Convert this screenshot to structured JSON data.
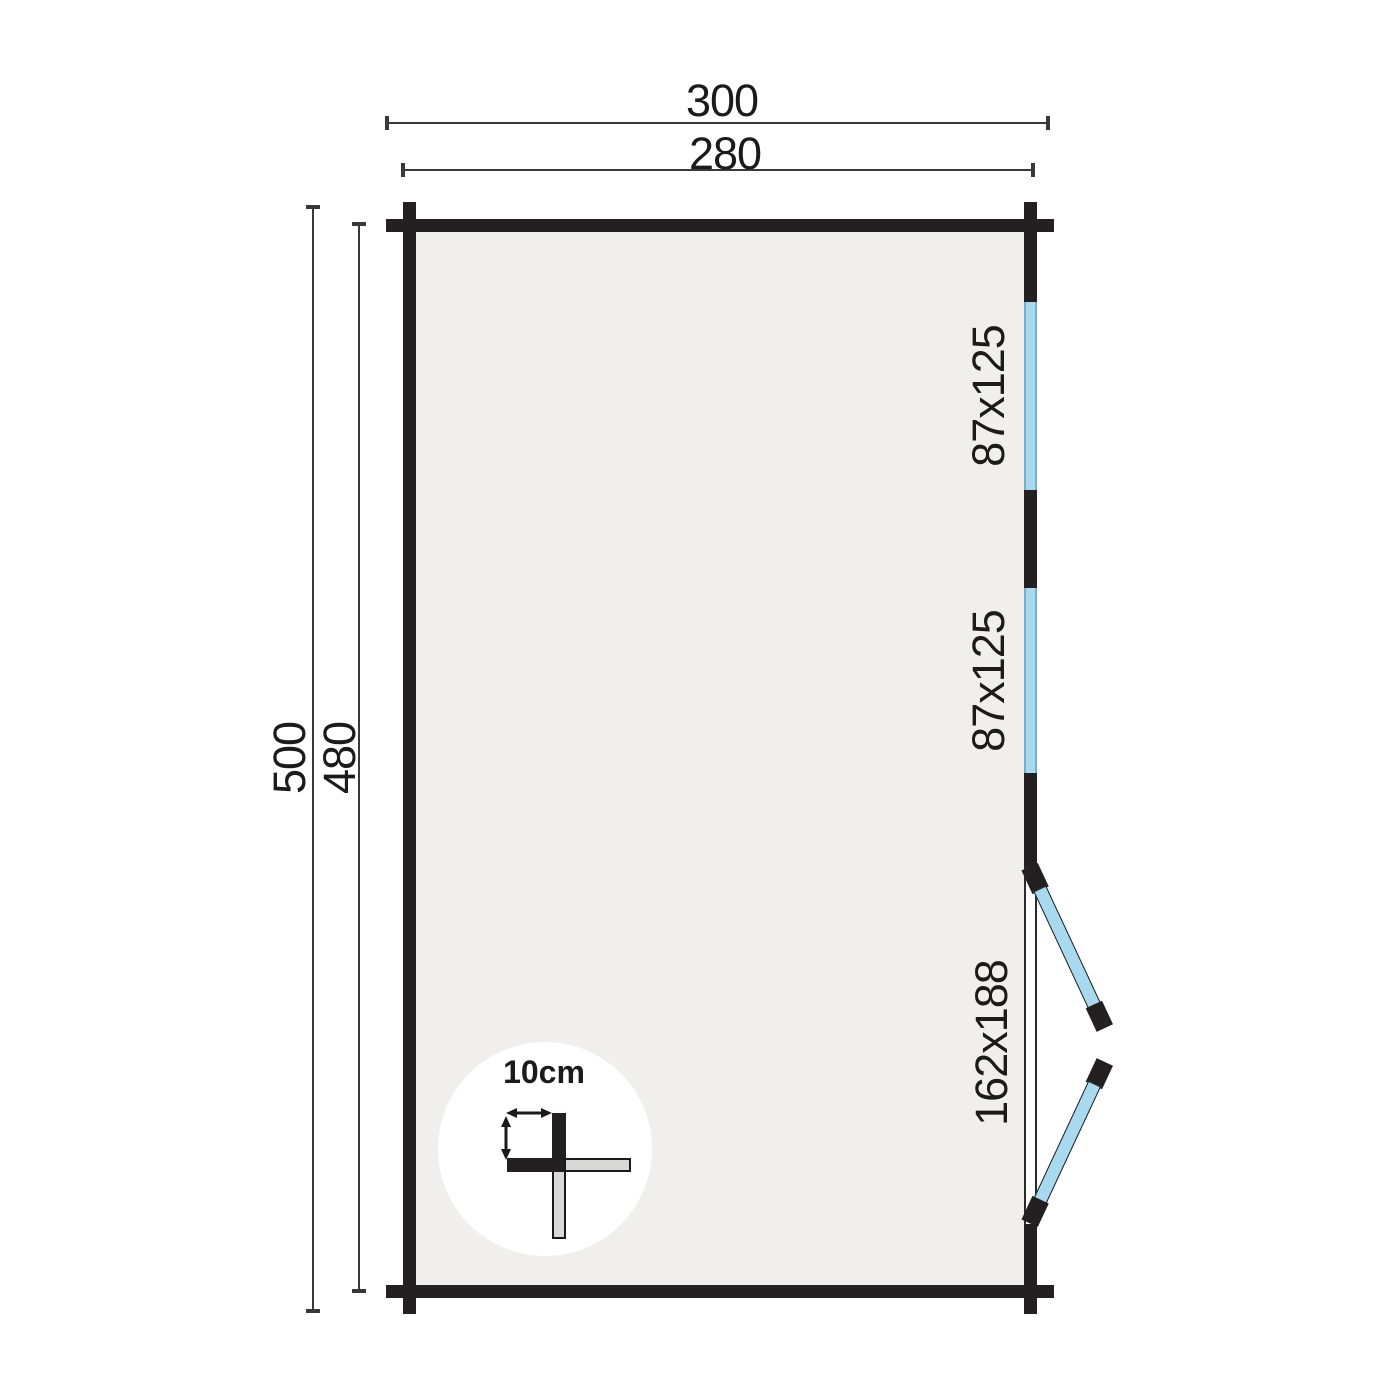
{
  "plan": {
    "dimensions": {
      "width_outer": "300",
      "width_inner": "280",
      "height_outer": "500",
      "height_inner": "480"
    },
    "openings": {
      "window_top": "87x125",
      "window_middle": "87x125",
      "door": "162x188"
    },
    "detail": {
      "wall_thickness": "10cm"
    }
  },
  "colors": {
    "wall": "#242021",
    "interior": "#f0efee",
    "glass": "#a7d9ef",
    "glass-edge": "#79aecb",
    "dimline": "#3b3838",
    "text": "#1c1a1a",
    "background": "#ffffff",
    "detail-fill": "#d8d8d6"
  }
}
